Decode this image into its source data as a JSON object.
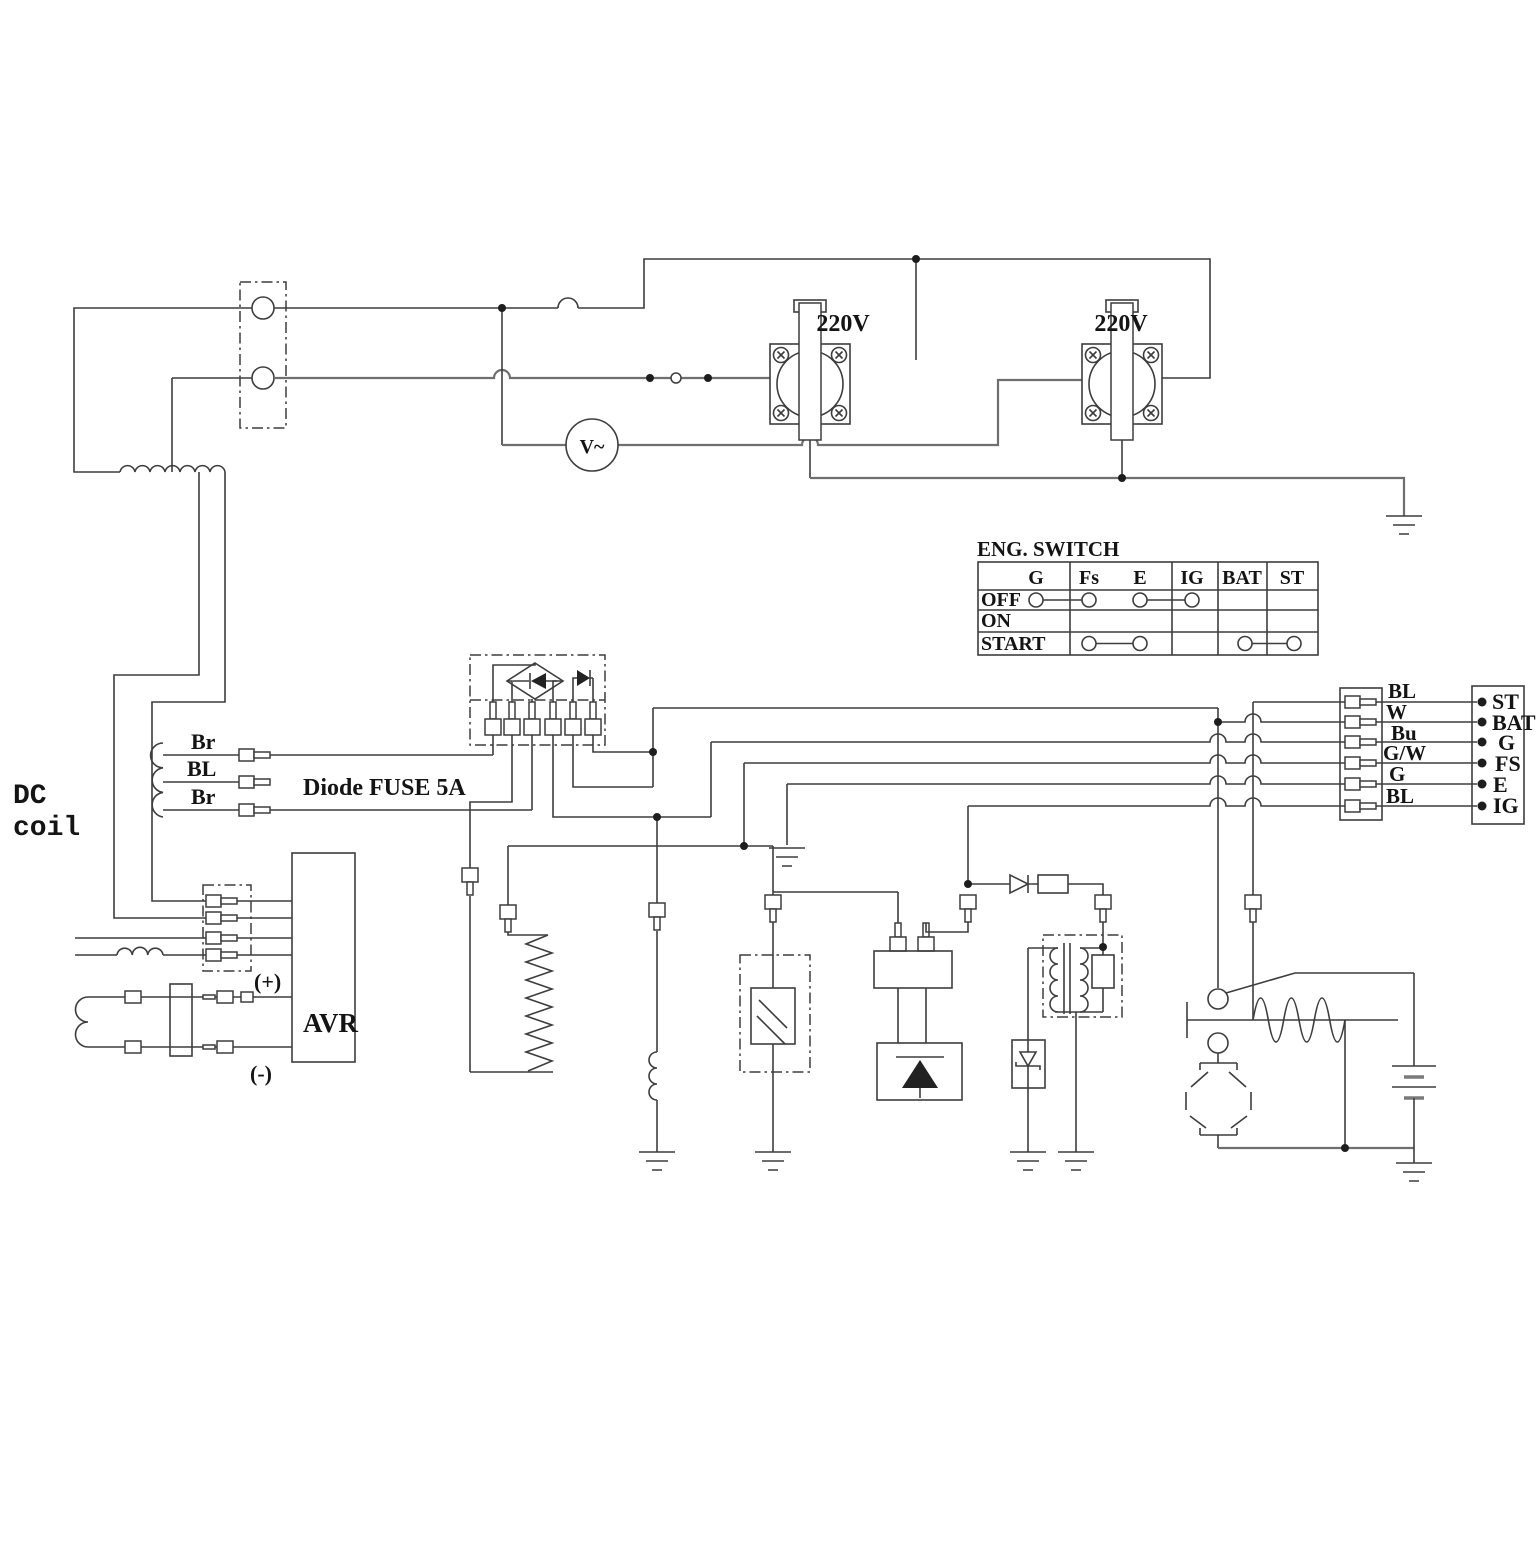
{
  "labels": {
    "dc_coil_line1": "DC",
    "dc_coil_line2": "coil",
    "dc_wire_top": "Br",
    "dc_wire_mid": "BL",
    "dc_wire_bottom": "Br",
    "diode_fuse": "Diode FUSE 5A",
    "avr": "AVR",
    "avr_plus": "(+)",
    "avr_minus": "(-)",
    "outlet1": "220V",
    "outlet2": "220V",
    "voltmeter": "V~"
  },
  "eng_switch": {
    "title": "ENG. SWITCH",
    "columns": [
      "G",
      "Fs",
      "E",
      "IG",
      "BAT",
      "ST"
    ],
    "rows": [
      "OFF",
      "ON",
      "START"
    ],
    "contact_pairs": {
      "OFF": [
        [
          "G",
          "Fs"
        ],
        [
          "E",
          "IG"
        ]
      ],
      "ON": [],
      "START": [
        [
          "Fs",
          "E"
        ],
        [
          "BAT",
          "ST"
        ]
      ]
    }
  },
  "harness": {
    "wire_labels": [
      "BL",
      "W",
      "Bu",
      "G/W",
      "G",
      "BL"
    ],
    "terminal_labels": [
      "ST",
      "BAT",
      "G",
      "FS",
      "E",
      "IG"
    ]
  },
  "colors": {
    "wire": "#3d3d3d",
    "text": "#141414",
    "background": "#ffffff"
  }
}
